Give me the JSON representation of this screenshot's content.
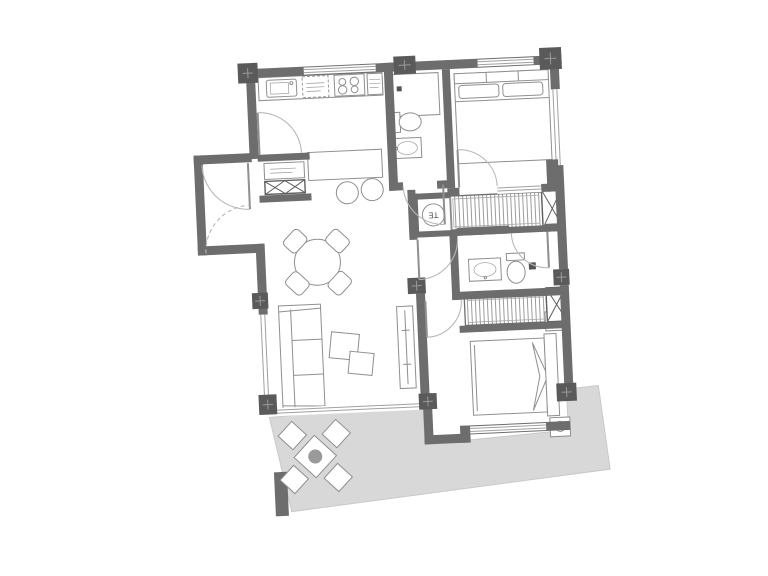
{
  "page": {
    "title": "apartment-floor-plan",
    "background": "#ffffff"
  },
  "plan": {
    "rotation_deg": -2.6,
    "labels": {
      "water_heater": "TE"
    },
    "colors": {
      "wall": "#6d6d6d",
      "pillar": "#5a5a5a",
      "terrace_floor": "#d8d8d8",
      "furniture_outline": "#8f8f8f",
      "door_arc": "#b8b8b8",
      "hatch": "#9b9b9b",
      "background": "#ffffff"
    },
    "rooms": [
      {
        "name": "kitchen",
        "fixtures": [
          "sink",
          "dishwasher-dashed",
          "cooktop-4-burner",
          "refrigerator",
          "island-counter",
          "bar-stool",
          "bar-stool",
          "service-shaft"
        ]
      },
      {
        "name": "entry-hall",
        "fixtures": [
          "entry-door",
          "closet-dashed-swing"
        ]
      },
      {
        "name": "living-dining",
        "fixtures": [
          "round-dining-table",
          "dining-chair-x4",
          "sofa-3-seat",
          "coffee-table-x2",
          "media-console"
        ]
      },
      {
        "name": "bathroom-1",
        "fixtures": [
          "shower",
          "toilet",
          "washbasin"
        ]
      },
      {
        "name": "bedroom-1",
        "fixtures": [
          "double-bed",
          "pillow-x2"
        ]
      },
      {
        "name": "utility-gallery-1",
        "fixtures": [
          "water-heater-TE",
          "drying-rack-hatched",
          "ventilation-shaft"
        ]
      },
      {
        "name": "corridor",
        "fixtures": [
          "door-swing-x3"
        ]
      },
      {
        "name": "bathroom-2",
        "fixtures": [
          "washbasin",
          "toilet",
          "shower-drain"
        ]
      },
      {
        "name": "utility-gallery-2",
        "fixtures": [
          "drying-rack-hatched",
          "ventilation-shaft"
        ]
      },
      {
        "name": "bedroom-2",
        "fixtures": [
          "double-bed",
          "nightstand-lamp",
          "nightstand-lamp"
        ]
      },
      {
        "name": "terrace",
        "fixtures": [
          "outdoor-table",
          "outdoor-chair-x4",
          "planter"
        ]
      }
    ],
    "counts": {
      "bedrooms": 2,
      "bathrooms": 2,
      "pillars": 9,
      "shafts": 3
    }
  }
}
